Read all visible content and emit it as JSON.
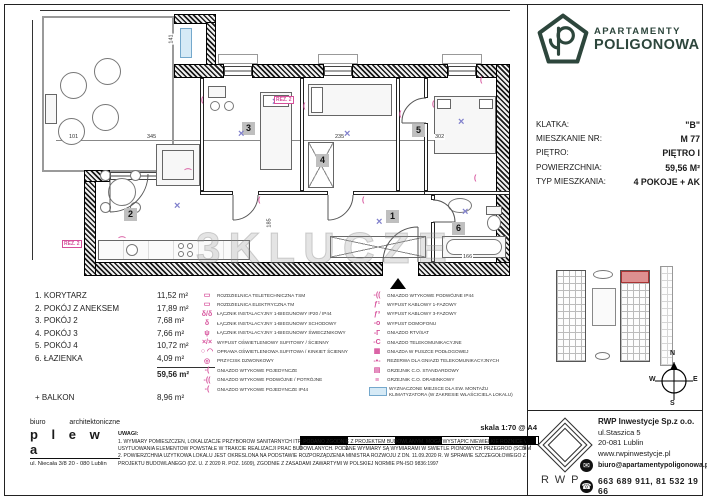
{
  "brand": {
    "line1": "APARTAMENTY",
    "line2": "POLIGONOWA"
  },
  "info": {
    "rows": [
      {
        "label": "KLATKA:",
        "value": "\"B\""
      },
      {
        "label": "MIESZKANIE NR:",
        "value": "M 77"
      },
      {
        "label": "PIĘTRO:",
        "value": "PIĘTRO I"
      },
      {
        "label": "POWIERZCHNIA:",
        "value": "59,56 M²"
      },
      {
        "label": "TYP MIESZKANIA:",
        "value": "4 POKOJE + AK"
      }
    ]
  },
  "plan": {
    "watermark": "3KLUCZE",
    "badges": [
      {
        "t": "1",
        "style": "left:358px;top:202px"
      },
      {
        "t": "2",
        "style": "left:96px;top:200px"
      },
      {
        "t": "3",
        "style": "left:214px;top:114px"
      },
      {
        "t": "4",
        "style": "left:288px;top:146px"
      },
      {
        "t": "5",
        "style": "left:384px;top:116px"
      },
      {
        "t": "6",
        "style": "left:424px;top:214px"
      }
    ],
    "dims": [
      {
        "t": "101",
        "cls": "",
        "style": "left:40px;top:126px"
      },
      {
        "t": "345",
        "cls": "",
        "style": "left:118px;top:126px"
      },
      {
        "t": "235",
        "cls": "",
        "style": "left:306px;top:126px"
      },
      {
        "t": "302",
        "cls": "",
        "style": "left:406px;top:126px"
      },
      {
        "t": "141",
        "cls": "v",
        "style": "left:138px;top:28px"
      },
      {
        "t": "185",
        "cls": "v",
        "style": "left:236px;top:212px"
      },
      {
        "t": "166",
        "cls": "",
        "style": "left:434px;top:246px"
      }
    ],
    "xmarks": [
      {
        "t": "×",
        "style": "left:146px;top:194px"
      },
      {
        "t": "×",
        "style": "left:210px;top:122px"
      },
      {
        "t": "×",
        "style": "left:316px;top:122px"
      },
      {
        "t": "×",
        "style": "left:430px;top:110px"
      },
      {
        "t": "×",
        "style": "left:348px;top:210px"
      },
      {
        "t": "×",
        "style": "left:434px;top:200px"
      },
      {
        "t": "×",
        "style": "left:244px;top:90px"
      }
    ],
    "pmarks": [
      {
        "t": "(",
        "style": "left:173px;top:90px"
      },
      {
        "t": "(",
        "style": "left:275px;top:96px"
      },
      {
        "t": "(",
        "style": "left:371px;top:104px"
      },
      {
        "t": "(",
        "style": "left:452px;top:70px"
      },
      {
        "t": "(",
        "style": "left:334px;top:190px"
      },
      {
        "t": "(",
        "style": "left:230px;top:190px"
      },
      {
        "t": "(",
        "style": "left:92px;top:226px;transform:rotate(90deg)"
      },
      {
        "t": "(",
        "style": "left:446px;top:168px"
      },
      {
        "t": "(",
        "style": "left:404px;top:94px"
      },
      {
        "t": "(",
        "style": "left:158px;top:158px;transform:rotate(90deg)"
      }
    ],
    "rez": [
      {
        "t": "REZ. 2",
        "style": "left:246px;top:88px"
      },
      {
        "t": "REZ. 2",
        "style": "left:34px;top:232px"
      }
    ]
  },
  "rooms": {
    "items": [
      {
        "name": "1. KORYTARZ",
        "area": "11,52 m²"
      },
      {
        "name": "2. POKÓJ Z ANEKSEM",
        "area": "17,89 m²"
      },
      {
        "name": "3. POKÓJ 2",
        "area": "7,68 m²"
      },
      {
        "name": "4. POKÓJ 3",
        "area": "7,66 m²"
      },
      {
        "name": "5. POKÓJ 4",
        "area": "10,72 m²"
      },
      {
        "name": "6. ŁAZIENKA",
        "area": "4,09 m²"
      }
    ],
    "total": "59,56 m²",
    "balkon_label": "+ BALKON",
    "balkon_area": "8,96 m²"
  },
  "legend": {
    "col1": [
      {
        "g": "▭",
        "cls": "",
        "label": "ROZDZIELNICA TELETECHNICZNA TSM"
      },
      {
        "g": "▭",
        "cls": "",
        "label": "ROZDZIELNICA ELEKTRYCZNA TM"
      },
      {
        "g": "δ/δ",
        "cls": "",
        "label": "ŁĄCZNIK INSTALACYJNY 1-BIEGUNOWY IP20 / IP44"
      },
      {
        "g": "δ",
        "cls": "",
        "label": "ŁĄCZNIK INSTALACYJNY 1-BIEGUNOWY SCHODOWY"
      },
      {
        "g": "ψ",
        "cls": "",
        "label": "ŁĄCZNIK INSTALACYJNY 1-BIEGUNOWY ŚWIECZNIKOWY"
      },
      {
        "g": "×/×",
        "cls": "",
        "label": "WYPUST OŚWIETLENIOWY SUFITOWY / ŚCIENNY"
      },
      {
        "g": "○ ◠",
        "cls": "",
        "label": "OPRAWA OŚWIETLENIOWA SUFITOWA / KINKIET ŚCIENNY"
      },
      {
        "g": "◎",
        "cls": "",
        "label": "PRZYCISK DZWONKOWY"
      },
      {
        "g": "-(",
        "cls": "",
        "label": "GNIAZDO WTYKOWE POJEDYNCZE"
      },
      {
        "g": "-((",
        "cls": "",
        "label": "GNIAZDO WTYKOWE PODWÓJNE / POTRÓJNE"
      },
      {
        "g": "-(",
        "cls": "",
        "label": "GNIAZDO WTYKOWE POJEDYNCZE IP44"
      }
    ],
    "col2": [
      {
        "g": "-((",
        "cls": "",
        "label": "GNIAZDO WTYKOWE PODWÓJNE IP44"
      },
      {
        "g": "ƒ¹",
        "cls": "",
        "label": "WYPUST KABLOWY 1-FAZOWY"
      },
      {
        "g": "ƒ³",
        "cls": "",
        "label": "WYPUST KABLOWY 3-FAZOWY"
      },
      {
        "g": "-o",
        "cls": "",
        "label": "WYPUST DOMOFONU"
      },
      {
        "g": "-Г",
        "cls": "",
        "label": "GNIAZDO RTV/SAT"
      },
      {
        "g": "-C",
        "cls": "",
        "label": "GNIAZDO TELEKOMUNIKACYJNE"
      },
      {
        "g": "▦",
        "cls": "",
        "label": "GNIAZDA W PUSZCE PODŁOGOWEJ"
      },
      {
        "g": "-•-",
        "cls": "",
        "label": "REZERWA DLA GNIAZD TELEKOMUNIKACYJNYCH"
      },
      {
        "g": "▤",
        "cls": "",
        "label": "GRZEJNIK C.O. STANDARDOWY"
      },
      {
        "g": "≡",
        "cls": "",
        "label": "GRZEJNIK C.O. DRABINKOWY"
      },
      {
        "g": "",
        "cls": "ac",
        "label": "WYZNACZONE MIEJSCE DLA EW. MONTAŻU KLIMATYZATORA (W ZAKRESIE WŁAŚCICIELA LOKALU)"
      }
    ]
  },
  "scale": {
    "label": "skala 1:70 @ A4",
    "t0": "0",
    "t1": "1",
    "t5": "5M"
  },
  "notes": {
    "title": "UWAGI:",
    "l1": "1. WYMIARY POMIESZCZEŃ, LOKALIZACJE PRZYBORÓW SANITARNYCH ITP. PODANO ZGODNIE Z PROJEKTEM BUDOWLANYM. MOGĄ WYSTĄPIĆ NIEWIELKIE RÓŻNICE WYMIARÓW I",
    "l2": "USYTUOWANIA ELEMENTÓW POWSTAŁE W TRAKCIE REALIZACJI PRAC BUDOWLANYCH. PODANE WYMIARY SĄ WYMIARAMI W ŚWIETLE PIONOWYCH PRZEGRÓD (ŚCIAN) W STANIE SUROWYM.",
    "l3": "2. POWIERZCHNIA UŻYTKOWA LOKALU JEST OKREŚLONA NA PODSTAWIE ROZPORZĄDZENIA MINISTRA ROZWOJU Z DN. 11.09.2020 R. W SPRAWIE SZCZEGÓŁOWEGO ZAKRESU I FORMY",
    "l4": "PROJEKTU BUDOWLANEGO (DZ. U. Z 2020 R. POZ. 1609), ZGODNIE Z ZASADAMI ZAWARTYMI W POLSKIEJ NORMIE PN-ISO 9836:1997"
  },
  "architect": {
    "w1": "biuro",
    "w2": "architektoniczne",
    "name": "p l e w a",
    "addr": "ul. Niecała 3/8  20 - 080 Lublin"
  },
  "developer": {
    "name": "RWP Inwestycje Sp.z o.o.",
    "addr1": "ul.Staszica 5",
    "addr2": "20-081 Lublin",
    "web": "www.rwpinwestycje.pl",
    "email": "biuro@apartamentypoligonowa.pl",
    "phones": "663 689 911,  81 532 19 66",
    "logo_text": "RWP"
  },
  "compass": {
    "n": "N",
    "e": "E",
    "s": "S",
    "w": "W"
  }
}
